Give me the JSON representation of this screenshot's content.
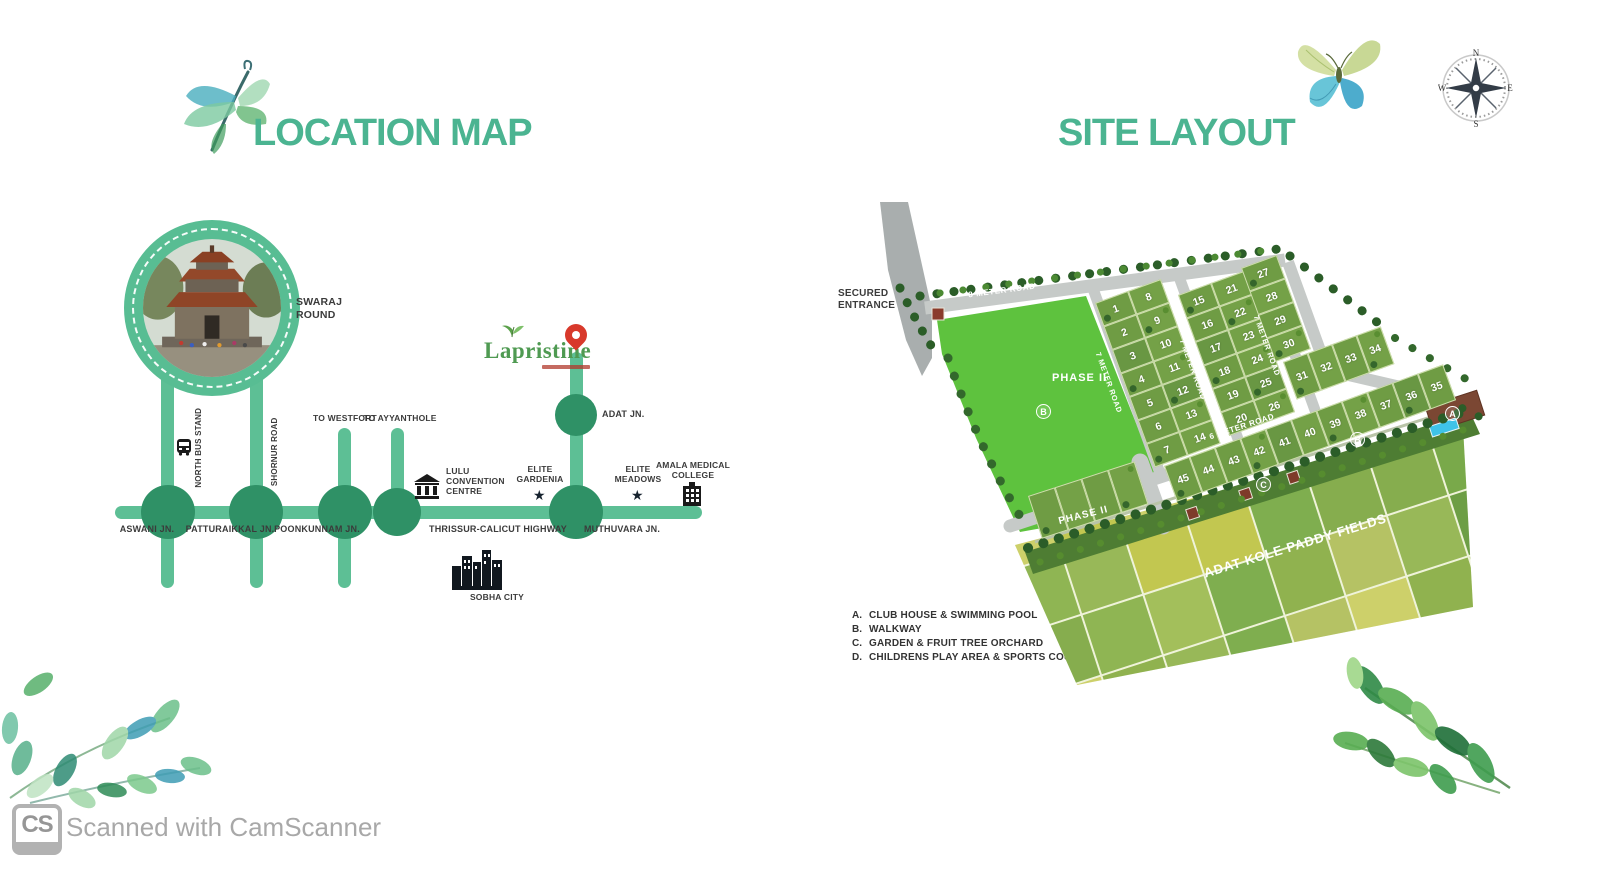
{
  "lm": {
    "title": "LOCATION MAP",
    "swaraj": "SWARAJ\nROUND",
    "logo": "Lapristine",
    "adat": "ADAT JN.",
    "highway": "THRISSUR-CALICUT HIGHWAY",
    "junctions": [
      "ASWANI JN.",
      "PATTURAIKKAL JN.",
      "POONKUNNAM JN.",
      "MUTHUVARA JN."
    ],
    "to_westfort": "TO WESTFORT",
    "to_ayyanthole": "TO AYYANTHOLE",
    "north_bus_stand": "NORTH BUS STAND",
    "shornur_road": "SHORNUR ROAD",
    "lulu": "LULU\nCONVENTION\nCENTRE",
    "elite_gardenia": "ELITE\nGARDENIA",
    "elite_meadows": "ELITE\nMEADOWS",
    "amala": "AMALA MEDICAL\nCOLLEGE",
    "sobha": "SOBHA CITY"
  },
  "sl": {
    "title": "SITE LAYOUT",
    "secured": "SECURED\nENTRANCE",
    "road8": "8 METER ROAD",
    "road7": "7 METER ROAD",
    "road6": "6 METER ROAD",
    "phase2": "PHASE II",
    "paddy": "ADAT KOLE PADDY FIELDS",
    "compass": {
      "n": "N",
      "e": "E",
      "s": "S",
      "w": "W"
    },
    "markers": {
      "a": "A",
      "b": "B",
      "c": "C"
    },
    "plots": {
      "a1": [
        "1",
        "2",
        "3",
        "4",
        "5",
        "6",
        "7"
      ],
      "a2": [
        "8",
        "9",
        "10",
        "11",
        "12",
        "13",
        "14"
      ],
      "b1": [
        "15",
        "16",
        "17",
        "18",
        "19",
        "20"
      ],
      "b2": [
        "21",
        "22",
        "23",
        "24",
        "25",
        "26"
      ],
      "c_col": [
        "27",
        "28",
        "29",
        "30"
      ],
      "c_row": [
        "31",
        "32",
        "33",
        "34"
      ],
      "south": [
        "45",
        "44",
        "43",
        "42",
        "41",
        "40",
        "39",
        "38",
        "37",
        "36",
        "35"
      ],
      "phase2_row": [
        "",
        "",
        "",
        ""
      ]
    },
    "legend": [
      {
        "key": "A.",
        "label": "CLUB HOUSE & SWIMMING POOL"
      },
      {
        "key": "B.",
        "label": "WALKWAY"
      },
      {
        "key": "C.",
        "label": "GARDEN & FRUIT TREE ORCHARD"
      },
      {
        "key": "D.",
        "label": "CHILDRENS PLAY AREA & SPORTS COURT"
      }
    ]
  },
  "wm": {
    "logo": "CS",
    "text": "Scanned with CamScanner"
  },
  "colors": {
    "accent_green": "#4bb491",
    "road_green": "#5dbf95",
    "junction_green": "#2f9166",
    "plot_green": "#6f9c44",
    "open_green": "#5ec23e",
    "pin_red": "#d8392b",
    "paddy_palette": [
      "#79a94a",
      "#8fb553",
      "#a3bf5b",
      "#c2c750",
      "#6d9e45",
      "#86ad4e",
      "#5f9140",
      "#b5c264",
      "#98b858",
      "#cdd06a",
      "#7fae4f",
      "#90b24f"
    ]
  }
}
